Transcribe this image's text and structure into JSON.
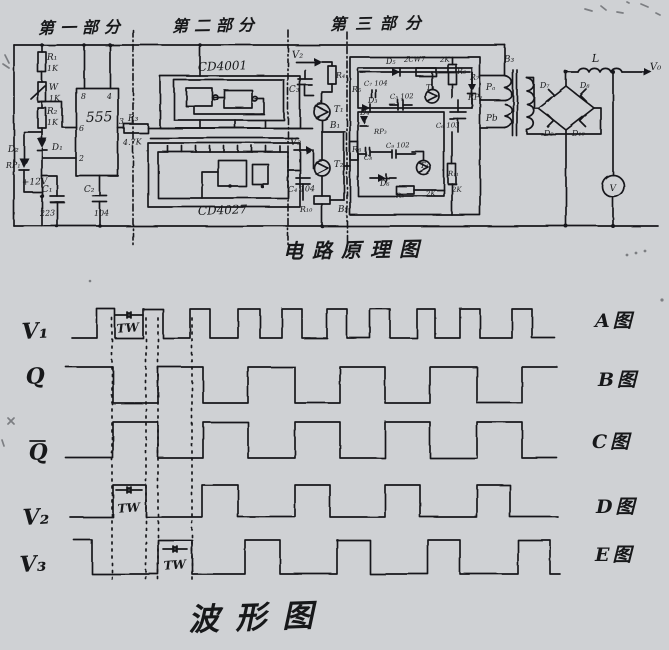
{
  "page": {
    "background": "#cfd1d4",
    "ink": "#17181a",
    "width": 669,
    "height": 650
  },
  "circuit": {
    "section_titles": [
      {
        "text": "第一部分",
        "x": 38,
        "y": 14
      },
      {
        "text": "第二部分",
        "x": 172,
        "y": 12
      },
      {
        "text": "第三部分",
        "x": 330,
        "y": 10
      }
    ],
    "caption": {
      "text": "电路原理图",
      "x": 283,
      "y": 234
    },
    "ics": [
      "555",
      "CD4001",
      "CD4027"
    ],
    "labels": [
      {
        "t": "R₁",
        "x": 47,
        "y": 60,
        "s": 9
      },
      {
        "t": "1K",
        "x": 47,
        "y": 71,
        "s": 8
      },
      {
        "t": "W",
        "x": 49,
        "y": 90,
        "s": 9
      },
      {
        "t": "1K",
        "x": 49,
        "y": 101,
        "s": 8
      },
      {
        "t": "R₂",
        "x": 47,
        "y": 114,
        "s": 9
      },
      {
        "t": "1K",
        "x": 47,
        "y": 125,
        "s": 8
      },
      {
        "t": "D₂",
        "x": 8,
        "y": 152,
        "s": 9
      },
      {
        "t": "D₁",
        "x": 52,
        "y": 150,
        "s": 9
      },
      {
        "t": "RP₁",
        "x": 6,
        "y": 168,
        "s": 8
      },
      {
        "t": "+12V",
        "x": 22,
        "y": 185,
        "s": 9
      },
      {
        "t": "C₁",
        "x": 42,
        "y": 192,
        "s": 9
      },
      {
        "t": "223",
        "x": 40,
        "y": 216,
        "s": 8
      },
      {
        "t": "C₂",
        "x": 84,
        "y": 192,
        "s": 9
      },
      {
        "t": "104",
        "x": 94,
        "y": 216,
        "s": 8
      },
      {
        "t": "555",
        "x": 86,
        "y": 122,
        "s": 14
      },
      {
        "t": "8",
        "x": 81,
        "y": 99,
        "s": 8
      },
      {
        "t": "4",
        "x": 107,
        "y": 99,
        "s": 8
      },
      {
        "t": "6",
        "x": 79,
        "y": 131,
        "s": 8
      },
      {
        "t": "2",
        "x": 79,
        "y": 161,
        "s": 8
      },
      {
        "t": "3",
        "x": 119,
        "y": 124,
        "s": 8
      },
      {
        "t": "R₃",
        "x": 128,
        "y": 121,
        "s": 9
      },
      {
        "t": "4.7K",
        "x": 123,
        "y": 145,
        "s": 8
      },
      {
        "t": "CD4001",
        "x": 198,
        "y": 71,
        "s": 12
      },
      {
        "t": "CD4027",
        "x": 198,
        "y": 215,
        "s": 12
      },
      {
        "t": "V₂",
        "x": 292,
        "y": 58,
        "s": 10
      },
      {
        "t": "R₄",
        "x": 336,
        "y": 78,
        "s": 8
      },
      {
        "t": "C₃",
        "x": 289,
        "y": 92,
        "s": 9
      },
      {
        "t": "T₁",
        "x": 334,
        "y": 112,
        "s": 9
      },
      {
        "t": "B₁",
        "x": 330,
        "y": 128,
        "s": 9
      },
      {
        "t": "V₃",
        "x": 290,
        "y": 145,
        "s": 10
      },
      {
        "t": "T₂",
        "x": 334,
        "y": 167,
        "s": 9
      },
      {
        "t": "C₄ 104",
        "x": 288,
        "y": 192,
        "s": 8
      },
      {
        "t": "R₁₀",
        "x": 300,
        "y": 212,
        "s": 8
      },
      {
        "t": "B₂",
        "x": 338,
        "y": 212,
        "s": 9
      },
      {
        "t": "D₅",
        "x": 386,
        "y": 64,
        "s": 8
      },
      {
        "t": "2CW7",
        "x": 404,
        "y": 62,
        "s": 7
      },
      {
        "t": "2K",
        "x": 440,
        "y": 62,
        "s": 7
      },
      {
        "t": "R₆",
        "x": 457,
        "y": 74,
        "s": 8
      },
      {
        "t": "R₇",
        "x": 470,
        "y": 80,
        "s": 8
      },
      {
        "t": "RP₂",
        "x": 468,
        "y": 100,
        "s": 8
      },
      {
        "t": "R₅",
        "x": 352,
        "y": 92,
        "s": 8
      },
      {
        "t": "C₇ 104",
        "x": 364,
        "y": 86,
        "s": 7
      },
      {
        "t": "T₃",
        "x": 426,
        "y": 90,
        "s": 8
      },
      {
        "t": "D₃",
        "x": 368,
        "y": 103,
        "s": 8
      },
      {
        "t": "C₅ 102",
        "x": 390,
        "y": 99,
        "s": 7
      },
      {
        "t": "C₆ 103",
        "x": 436,
        "y": 128,
        "s": 7
      },
      {
        "t": "D₄",
        "x": 360,
        "y": 115,
        "s": 8
      },
      {
        "t": "RP₃",
        "x": 374,
        "y": 134,
        "s": 7
      },
      {
        "t": "R₈",
        "x": 352,
        "y": 152,
        "s": 8
      },
      {
        "t": "C₈",
        "x": 364,
        "y": 160,
        "s": 7
      },
      {
        "t": "C₉ 102",
        "x": 386,
        "y": 148,
        "s": 7
      },
      {
        "t": "T₄",
        "x": 420,
        "y": 168,
        "s": 8
      },
      {
        "t": "D₆",
        "x": 380,
        "y": 186,
        "s": 8
      },
      {
        "t": "R₉",
        "x": 396,
        "y": 198,
        "s": 7
      },
      {
        "t": "2K",
        "x": 426,
        "y": 196,
        "s": 7
      },
      {
        "t": "R₁₁",
        "x": 448,
        "y": 176,
        "s": 7
      },
      {
        "t": "2K",
        "x": 452,
        "y": 192,
        "s": 7
      },
      {
        "t": "B₃",
        "x": 504,
        "y": 62,
        "s": 9
      },
      {
        "t": "Pₐ",
        "x": 486,
        "y": 90,
        "s": 9
      },
      {
        "t": "Pb",
        "x": 486,
        "y": 121,
        "s": 9
      },
      {
        "t": "D₇",
        "x": 540,
        "y": 88,
        "s": 8
      },
      {
        "t": "D₈",
        "x": 580,
        "y": 88,
        "s": 8
      },
      {
        "t": "D₉",
        "x": 544,
        "y": 136,
        "s": 8
      },
      {
        "t": "D₁₀",
        "x": 572,
        "y": 136,
        "s": 8
      },
      {
        "t": "L",
        "x": 592,
        "y": 62,
        "s": 11
      },
      {
        "t": "V₀",
        "x": 650,
        "y": 70,
        "s": 10
      },
      {
        "t": "V",
        "x": 613,
        "y": 191,
        "s": 9,
        "a": "middle"
      }
    ]
  },
  "chart_data": {
    "type": "timing",
    "title": "波形图",
    "caption": {
      "text": "波形图",
      "x": 188,
      "y": 592
    },
    "rows": [
      {
        "id": "V1",
        "label": "V₁",
        "bar": false,
        "figure": "A图",
        "initial": "low",
        "high_y": 309,
        "low_y": 338,
        "start_x": 72,
        "end_x": 555,
        "toggles": [
          97,
          115,
          143,
          163,
          190,
          210,
          238,
          260,
          282,
          302,
          327,
          347,
          370,
          390,
          417,
          435,
          460,
          480,
          512,
          532
        ],
        "label_x": 22,
        "label_y": 339,
        "figure_x": 595,
        "figure_y": 327
      },
      {
        "id": "Q",
        "label": "Q",
        "bar": false,
        "figure": "B图",
        "initial": "high",
        "high_y": 367,
        "low_y": 403,
        "start_x": 66,
        "end_x": 557,
        "toggles": [
          113,
          158,
          203,
          248,
          295,
          340,
          385,
          430,
          477,
          522
        ],
        "label_x": 26,
        "label_y": 384,
        "figure_x": 598,
        "figure_y": 386
      },
      {
        "id": "Qbar",
        "label": "Q",
        "bar": true,
        "figure": "C图",
        "initial": "low",
        "high_y": 422,
        "low_y": 458,
        "start_x": 66,
        "end_x": 557,
        "toggles": [
          113,
          158,
          203,
          248,
          295,
          340,
          385,
          430,
          477,
          522
        ],
        "label_x": 29,
        "label_y": 460,
        "figure_x": 592,
        "figure_y": 448
      },
      {
        "id": "V2",
        "label": "V₂",
        "bar": false,
        "figure": "D图",
        "initial": "low",
        "high_y": 485,
        "low_y": 517,
        "start_x": 70,
        "end_x": 558,
        "toggles": [
          113,
          146,
          202,
          238,
          295,
          330,
          385,
          420,
          477,
          510
        ],
        "label_x": 23,
        "label_y": 525,
        "figure_x": 596,
        "figure_y": 513
      },
      {
        "id": "V3",
        "label": "V₃",
        "bar": false,
        "figure": "E图",
        "initial": "high",
        "high_y": 540,
        "low_y": 574,
        "start_x": 74,
        "end_x": 560,
        "toggles": [
          92,
          158,
          192,
          245,
          280,
          337,
          370,
          428,
          460,
          518,
          550
        ],
        "label_x": 20,
        "label_y": 572,
        "figure_x": 595,
        "figure_y": 561
      }
    ],
    "guides": {
      "xs": [
        112,
        146,
        158,
        192
      ],
      "y1": 318,
      "y2": 582
    },
    "tw_marks": [
      {
        "label": "TW",
        "x1": 115,
        "x2": 143,
        "arrow_y": 315,
        "text_x": 128,
        "text_y": 332
      },
      {
        "label": "TW",
        "x1": 116,
        "x2": 142,
        "arrow_y": 490,
        "text_x": 129,
        "text_y": 512
      },
      {
        "label": "TW",
        "x1": 163,
        "x2": 187,
        "arrow_y": 549,
        "text_x": 175,
        "text_y": 569
      }
    ]
  }
}
